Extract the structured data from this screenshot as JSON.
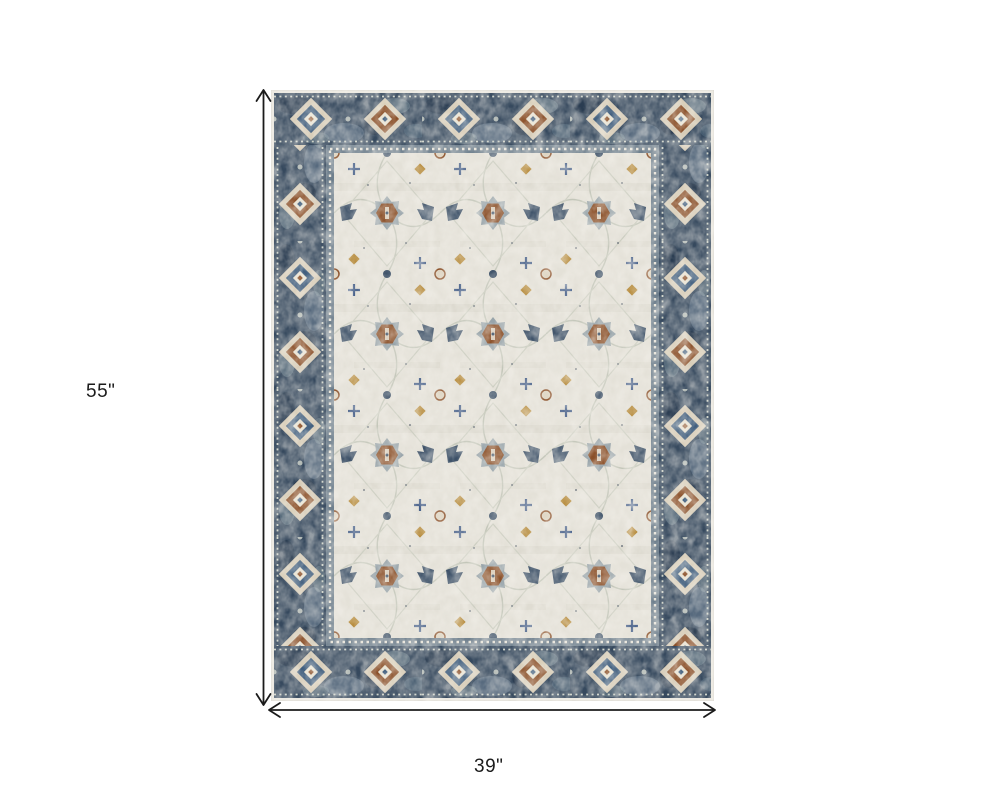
{
  "dimensions": {
    "height_label": "55\"",
    "width_label": "39\""
  },
  "icons": {
    "height_arrow": "double-headed-vertical-arrow",
    "width_arrow": "double-headed-horizontal-arrow"
  },
  "product": {
    "description_of_pixels": "distressed oriental area rug, ivory field with navy border and rust accents"
  },
  "colors": {
    "background": "#ffffff",
    "dimension_line": "#1b1b1b",
    "rug_border_navy": "#36495e",
    "rug_border_dark": "#24364a",
    "rug_gray_blue": "#7e93a4",
    "rug_field_ivory": "#e4e1d8",
    "rug_edge_ivory": "#ebe8e0",
    "rug_accent_rust": "#8a4f28",
    "rug_accent_gold": "#b68a3a",
    "rug_accent_blue": "#3d5168",
    "rug_outline_gray": "#c3c6b9"
  }
}
